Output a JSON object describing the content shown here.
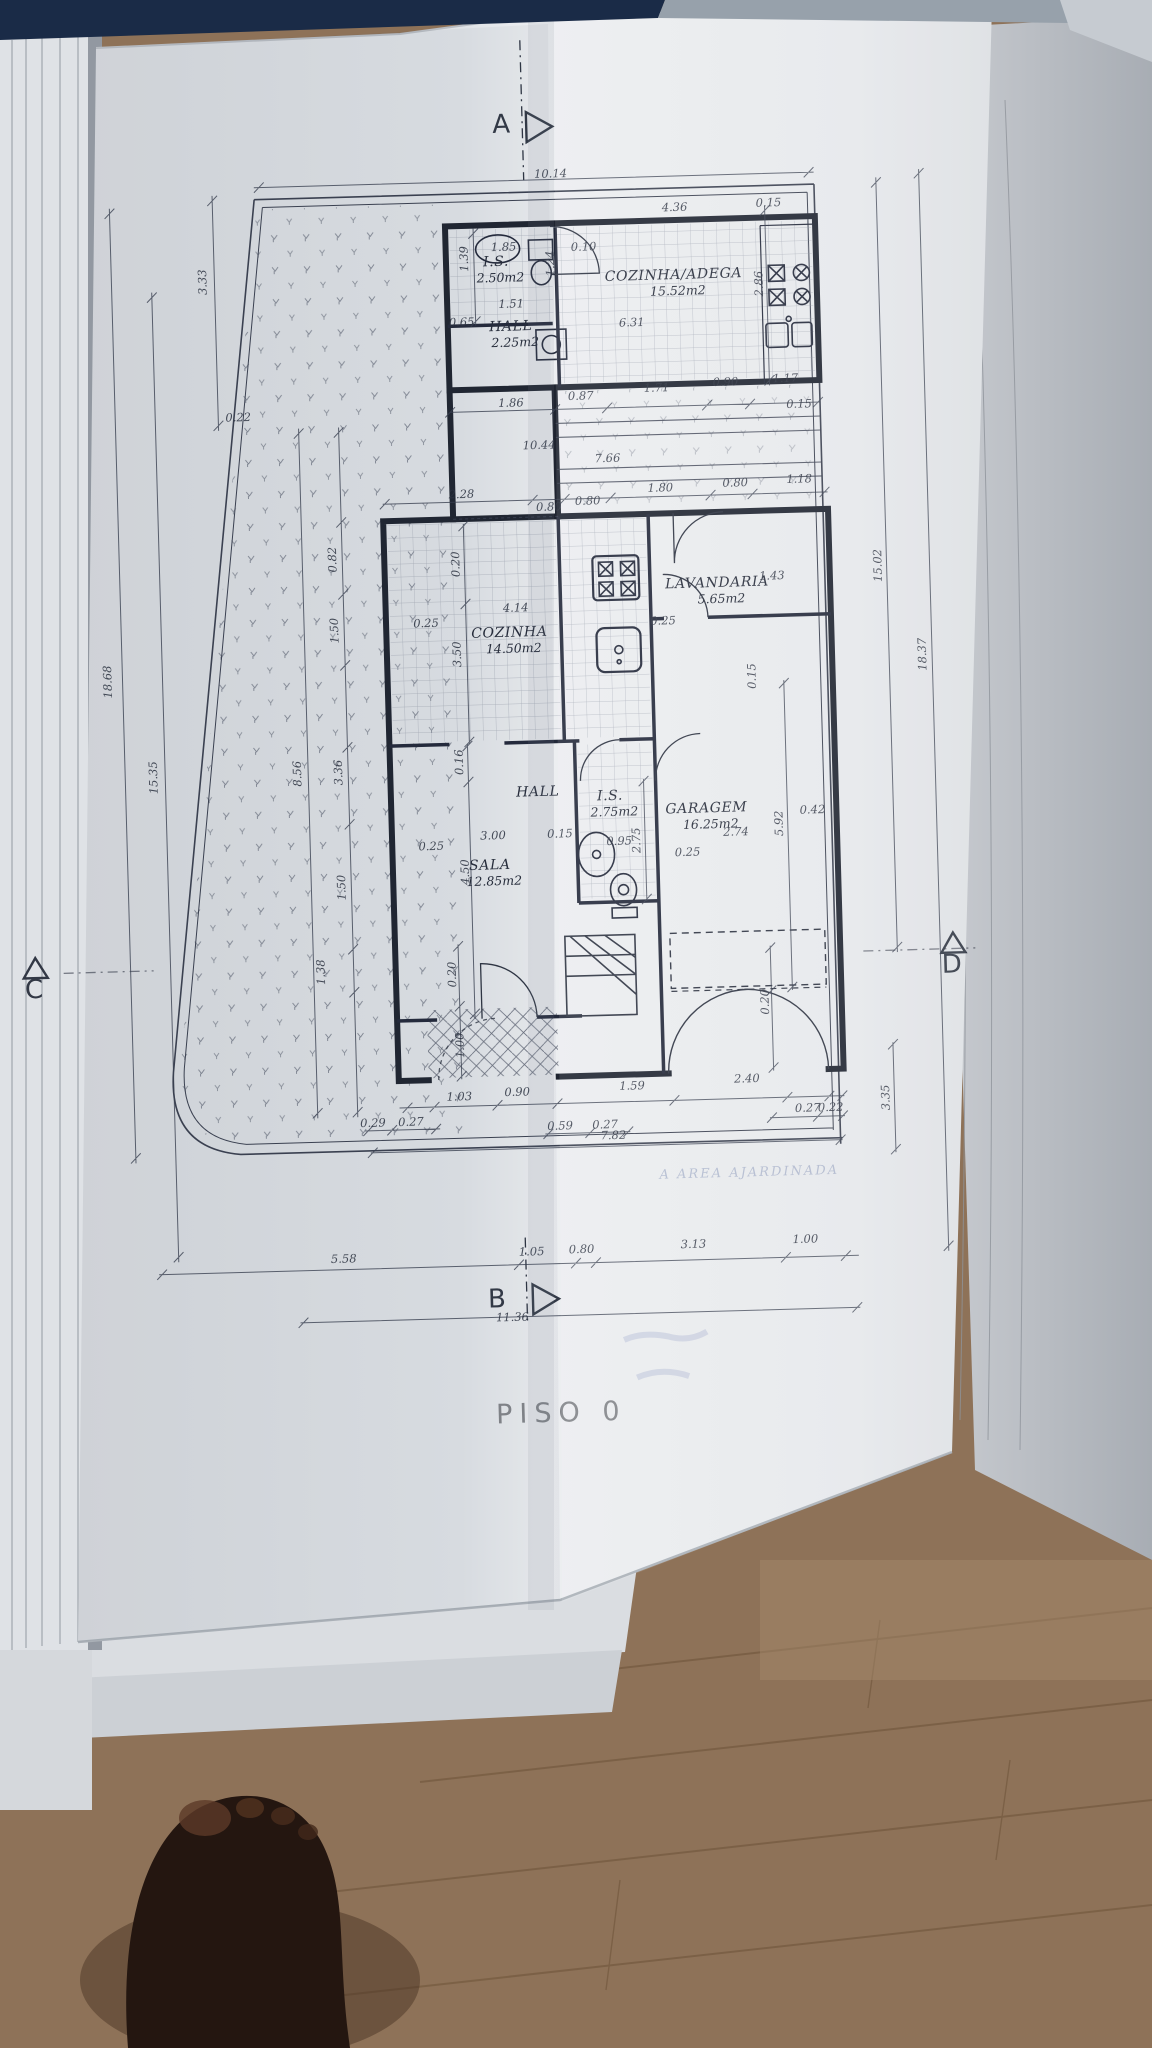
{
  "document": {
    "type": "architectural floor plan photo",
    "floor_title": "PISO  0",
    "faint_annotation": "A  AREA  AJARDINADA",
    "overall_width_label": "11.36"
  },
  "colors": {
    "paper": "#e7e9ec",
    "paper_dark": "#d9dce1",
    "ink": "#2e3442",
    "wall": "#1f2430",
    "navy_strip": "#1a2b47",
    "wood": "#8e7258",
    "wood_line": "#6d5339",
    "foot": "#241610"
  },
  "markers": [
    {
      "id": "A",
      "label": "A",
      "x": 399,
      "y": 40,
      "tri": "right",
      "tx": 424,
      "ty": 20
    },
    {
      "id": "B",
      "label": "B",
      "x": 362,
      "y": 1214,
      "tri": "right",
      "tx": 398,
      "ty": 1192
    },
    {
      "id": "C",
      "label": "C",
      "x": -92,
      "y": 892,
      "tri": "up",
      "tx": -90,
      "ty": 852
    },
    {
      "id": "D",
      "label": "D",
      "x": 826,
      "y": 892,
      "tri": "up",
      "tx": 828,
      "ty": 852
    }
  ],
  "rooms": [
    {
      "name": "I.S.",
      "area": "2.50m2",
      "x": 390,
      "y": 173
    },
    {
      "name": "HALL",
      "area": "2.25m2",
      "x": 403,
      "y": 238
    },
    {
      "name": "COZINHA/ADEGA",
      "area": "15.52m2",
      "x": 567,
      "y": 191
    },
    {
      "name": "COZINHA",
      "area": "14.50m2",
      "x": 393,
      "y": 544
    },
    {
      "name": "LAVANDARIA",
      "area": "5.65m2",
      "x": 602,
      "y": 500
    },
    {
      "name": "HALL",
      "area": "",
      "x": 417,
      "y": 704
    },
    {
      "name": "I.S.",
      "area": "2.75m2",
      "x": 489,
      "y": 710
    },
    {
      "name": "SALA",
      "area": "12.85m2",
      "x": 367,
      "y": 776
    },
    {
      "name": "GARAGEM",
      "area": "16.25m2",
      "x": 585,
      "y": 725
    }
  ],
  "dims": [
    {
      "t": "10.14",
      "x": 447,
      "y": 86
    },
    {
      "t": "4.36",
      "x": 570,
      "y": 123
    },
    {
      "t": "0.15",
      "x": 664,
      "y": 121
    },
    {
      "t": "0.10",
      "x": 478,
      "y": 160
    },
    {
      "t": "1.85",
      "x": 398,
      "y": 158
    },
    {
      "t": "1.39",
      "x": 362,
      "y": 165,
      "r": 1
    },
    {
      "t": "1.24",
      "x": 448,
      "y": 172,
      "r": 1
    },
    {
      "t": "1.51",
      "x": 404,
      "y": 215
    },
    {
      "t": "0.65",
      "x": 354,
      "y": 232
    },
    {
      "t": "2.86",
      "x": 656,
      "y": 198,
      "r": 1
    },
    {
      "t": "6.31",
      "x": 524,
      "y": 237
    },
    {
      "t": "3.33",
      "x": 100,
      "y": 181,
      "r": 1
    },
    {
      "t": "1.86",
      "x": 401,
      "y": 314
    },
    {
      "t": "0.87",
      "x": 471,
      "y": 309
    },
    {
      "t": "1.71",
      "x": 547,
      "y": 303
    },
    {
      "t": "0.90",
      "x": 616,
      "y": 299
    },
    {
      "t": "1.17",
      "x": 676,
      "y": 297
    },
    {
      "t": "0.15",
      "x": 689,
      "y": 323
    },
    {
      "t": "10.44",
      "x": 428,
      "y": 357
    },
    {
      "t": "7.66",
      "x": 496,
      "y": 372
    },
    {
      "t": "0.22",
      "x": 128,
      "y": 321
    },
    {
      "t": "2.28",
      "x": 349,
      "y": 404
    },
    {
      "t": "0.80",
      "x": 436,
      "y": 419
    },
    {
      "t": "0.80",
      "x": 475,
      "y": 414
    },
    {
      "t": "1.80",
      "x": 548,
      "y": 403
    },
    {
      "t": "0.80",
      "x": 623,
      "y": 400
    },
    {
      "t": "1.18",
      "x": 687,
      "y": 398
    },
    {
      "t": "18.68",
      "x": -6,
      "y": 578,
      "r": 1
    },
    {
      "t": "15.35",
      "x": 37,
      "y": 675,
      "r": 1
    },
    {
      "t": "8.56",
      "x": 181,
      "y": 675,
      "r": 1
    },
    {
      "t": "3.36",
      "x": 222,
      "y": 675,
      "r": 1
    },
    {
      "t": "0.82",
      "x": 222,
      "y": 462,
      "r": 1
    },
    {
      "t": "1.50",
      "x": 222,
      "y": 533,
      "r": 1
    },
    {
      "t": "1.50",
      "x": 222,
      "y": 790,
      "r": 1
    },
    {
      "t": "1.38",
      "x": 199,
      "y": 874,
      "r": 1
    },
    {
      "t": "0.20",
      "x": 345,
      "y": 470,
      "r": 1
    },
    {
      "t": "3.50",
      "x": 344,
      "y": 560,
      "r": 1
    },
    {
      "t": "0.16",
      "x": 343,
      "y": 668,
      "r": 1
    },
    {
      "t": "4.50",
      "x": 346,
      "y": 778,
      "r": 1
    },
    {
      "t": "0.20",
      "x": 330,
      "y": 880,
      "r": 1
    },
    {
      "t": "1.00",
      "x": 336,
      "y": 951,
      "r": 1
    },
    {
      "t": "0.20",
      "x": 642,
      "y": 916,
      "r": 1
    },
    {
      "t": "2.75",
      "x": 518,
      "y": 751,
      "r": 1
    },
    {
      "t": "5.92",
      "x": 661,
      "y": 738,
      "r": 1
    },
    {
      "t": "0.15",
      "x": 638,
      "y": 590,
      "r": 1
    },
    {
      "t": "4.14",
      "x": 400,
      "y": 519
    },
    {
      "t": "0.25",
      "x": 310,
      "y": 532
    },
    {
      "t": "0.25",
      "x": 547,
      "y": 536
    },
    {
      "t": "1.43",
      "x": 657,
      "y": 494
    },
    {
      "t": "3.00",
      "x": 371,
      "y": 746
    },
    {
      "t": "0.15",
      "x": 438,
      "y": 746
    },
    {
      "t": "0.95",
      "x": 497,
      "y": 755
    },
    {
      "t": "0.25",
      "x": 309,
      "y": 755
    },
    {
      "t": "0.25",
      "x": 565,
      "y": 768
    },
    {
      "t": "0.42",
      "x": 691,
      "y": 729
    },
    {
      "t": "2.74",
      "x": 614,
      "y": 749
    },
    {
      "t": "15.02",
      "x": 767,
      "y": 483,
      "r": 1
    },
    {
      "t": "18.37",
      "x": 809,
      "y": 573,
      "r": 1
    },
    {
      "t": "3.35",
      "x": 760,
      "y": 1015,
      "r": 1
    },
    {
      "t": "1.03",
      "x": 330,
      "y": 1006
    },
    {
      "t": "0.90",
      "x": 388,
      "y": 1003
    },
    {
      "t": "1.59",
      "x": 503,
      "y": 1000
    },
    {
      "t": "2.40",
      "x": 618,
      "y": 996
    },
    {
      "t": "0.29",
      "x": 243,
      "y": 1030
    },
    {
      "t": "0.27",
      "x": 281,
      "y": 1030
    },
    {
      "t": "0.59",
      "x": 430,
      "y": 1038
    },
    {
      "t": "0.27",
      "x": 475,
      "y": 1038
    },
    {
      "t": "7.82",
      "x": 483,
      "y": 1049
    },
    {
      "t": "0.27",
      "x": 678,
      "y": 1027
    },
    {
      "t": "0.22",
      "x": 701,
      "y": 1027
    },
    {
      "t": "5.58",
      "x": 210,
      "y": 1165
    },
    {
      "t": "1.05",
      "x": 398,
      "y": 1163
    },
    {
      "t": "0.80",
      "x": 448,
      "y": 1162
    },
    {
      "t": "3.13",
      "x": 560,
      "y": 1160
    },
    {
      "t": "1.00",
      "x": 672,
      "y": 1158
    },
    {
      "t": "11.36",
      "x": 377,
      "y": 1228
    }
  ]
}
